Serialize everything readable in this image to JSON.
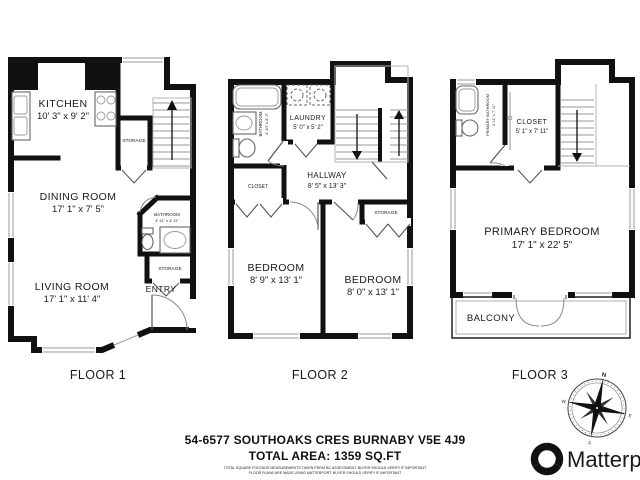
{
  "floors": [
    {
      "label": "FLOOR 1",
      "rooms": {
        "kitchen": {
          "name": "KITCHEN",
          "dims": "10' 3\" x 9' 2\""
        },
        "dining": {
          "name": "DINING ROOM",
          "dims": "17' 1\" x 7' 5\""
        },
        "living": {
          "name": "LIVING ROOM",
          "dims": "17' 1\" x 11' 4\""
        },
        "bathroom": {
          "name": "BATHROOM",
          "dims": "4' 11\" x 4' 11\""
        },
        "storage_upper": {
          "name": "STORAGE"
        },
        "storage_lower": {
          "name": "STORAGE"
        },
        "entry": {
          "name": "ENTRY"
        }
      }
    },
    {
      "label": "FLOOR 2",
      "rooms": {
        "bathroom": {
          "name": "BATHROOM",
          "dims": "4' 10\" x 8' 2\""
        },
        "laundry": {
          "name": "LAUNDRY",
          "dims": "5' 0\" x 5' 2\""
        },
        "hallway": {
          "name": "HALLWAY",
          "dims": "8' 5\" x 13' 3\""
        },
        "closet": {
          "name": "CLOSET"
        },
        "storage": {
          "name": "STORAGE"
        },
        "bedroom_left": {
          "name": "BEDROOM",
          "dims": "8' 9\" x 13' 1\""
        },
        "bedroom_right": {
          "name": "BEDROOM",
          "dims": "8' 0\" x 13' 1\""
        }
      }
    },
    {
      "label": "FLOOR 3",
      "rooms": {
        "primary_bathroom": {
          "name": "PRIMARY BATHROOM",
          "dims": "4' 11\" x 7' 11\""
        },
        "closet": {
          "name": "CLOSET",
          "dims": "5' 1\" x 7' 11\""
        },
        "primary_bedroom": {
          "name": "PRIMARY BEDROOM",
          "dims": "17' 1\" x 22' 5\""
        },
        "balcony": {
          "name": "BALCONY"
        }
      }
    }
  ],
  "footer": {
    "address": "54-6577 SOUTHOAKS CRES BURNABY V5E 4J9",
    "total_area": "TOTAL AREA: 1359 SQ.FT",
    "disclaimer_line1": "TOTAL SQUARE FOOTAGE MEASUREMENTS TAKEN FROM BC ASSESSMENT. BUYER SHOULD VERIFY IF IMPORTANT",
    "disclaimer_line2": "FLOOR PLANS ARE MADE USING MATTERPORT. BUYER SHOULD VERIFY IF IMPORTANT"
  },
  "compass": {
    "n": "N",
    "e": "E",
    "s": "S",
    "w": "W"
  },
  "brand": {
    "name": "Matterport"
  },
  "colors": {
    "wall": "#111111",
    "fixture": "#666666",
    "background": "#ffffff"
  }
}
